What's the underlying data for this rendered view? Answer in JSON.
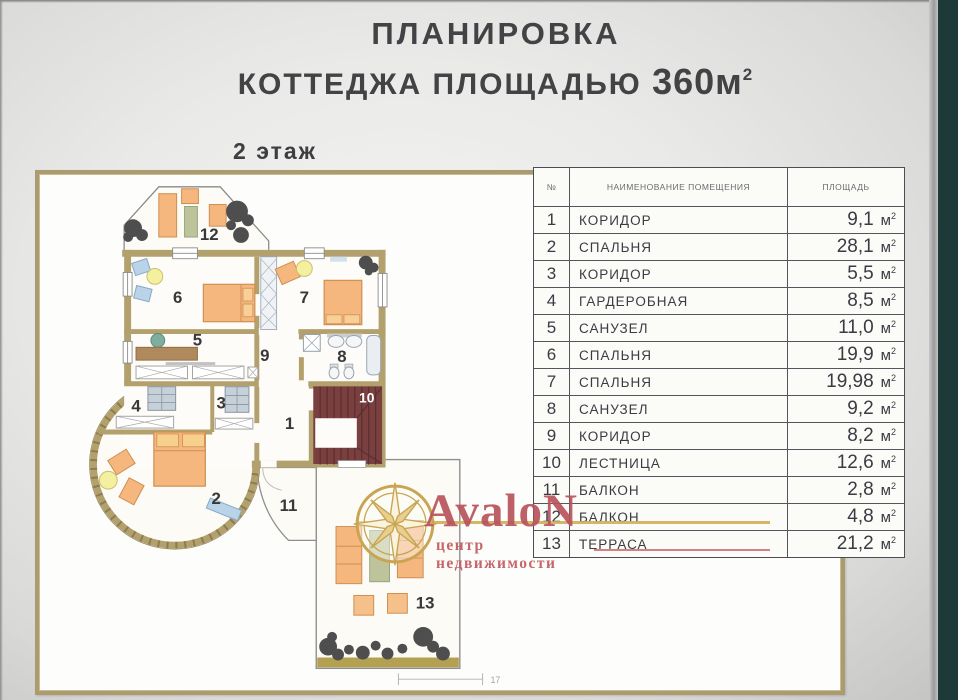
{
  "title": {
    "line1": "ПЛАНИРОВКА",
    "line2": "КОТТЕДЖА ПЛОЩАДЬЮ",
    "area": "360м",
    "area_sup": "2"
  },
  "floor_label": "2 этаж",
  "plan": {
    "labels": [
      "1",
      "2",
      "3",
      "4",
      "5",
      "6",
      "7",
      "8",
      "9",
      "10",
      "11",
      "12",
      "13"
    ],
    "dimension": "17"
  },
  "table": {
    "headers": {
      "num": "№",
      "name": "НАИМЕНОВАНИЕ ПОМЕЩЕНИЯ",
      "area": "ПЛОЩАДЬ"
    },
    "unit": "м",
    "unit_sup": "2",
    "rows": [
      {
        "num": "1",
        "name": "КОРИДОР",
        "area": "9,1"
      },
      {
        "num": "2",
        "name": "СПАЛЬНЯ",
        "area": "28,1"
      },
      {
        "num": "3",
        "name": "КОРИДОР",
        "area": "5,5"
      },
      {
        "num": "4",
        "name": "ГАРДЕРОБНАЯ",
        "area": "8,5"
      },
      {
        "num": "5",
        "name": "САНУЗЕЛ",
        "area": "11,0"
      },
      {
        "num": "6",
        "name": "СПАЛЬНЯ",
        "area": "19,9"
      },
      {
        "num": "7",
        "name": "СПАЛЬНЯ",
        "area": "19,98"
      },
      {
        "num": "8",
        "name": "САНУЗЕЛ",
        "area": "9,2"
      },
      {
        "num": "9",
        "name": "КОРИДОР",
        "area": "8,2"
      },
      {
        "num": "10",
        "name": "ЛЕСТНИЦА",
        "area": "12,6"
      },
      {
        "num": "11",
        "name": "БАЛКОН",
        "area": "2,8"
      },
      {
        "num": "12",
        "name": "БАЛКОН",
        "area": "4,8"
      },
      {
        "num": "13",
        "name": "ТЕРРАСА",
        "area": "21,2"
      }
    ]
  },
  "logo": {
    "name": "AvaloN",
    "tagline": "центр недвижимости"
  },
  "colors": {
    "wall": "#b2a06d",
    "stairs": "#7a4040",
    "furniture_orange": "#f5b77e",
    "teal_band": "#1e3a38",
    "logo_red": "#bb545b",
    "logo_gold": "#c9a452"
  }
}
